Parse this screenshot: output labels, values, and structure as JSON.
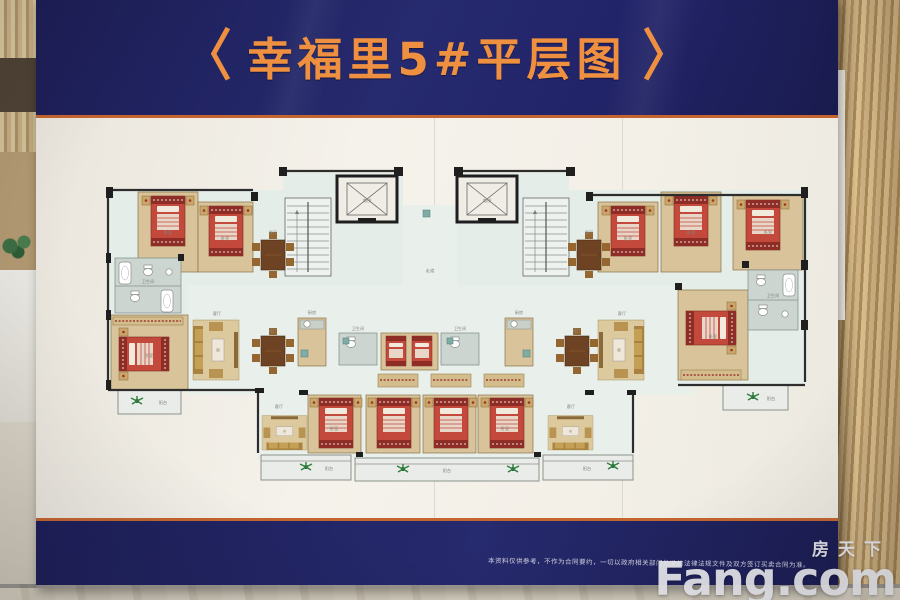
{
  "header": {
    "bracket_left": "〈",
    "title": "幸福里5#平层图",
    "bracket_right": "〉"
  },
  "footer": {
    "disclaimer": "本资料仅供参考，不作为合同要约，一切以政府相关部门批准的法律法规文件及双方签订买卖合同为准。"
  },
  "watermark": {
    "site_cn": "房天下",
    "site_en": "Fang.com"
  },
  "plan": {
    "name": "幸福里5#平层图",
    "labels": {
      "bedroom": "卧室",
      "living": "客厅",
      "dining": "餐厅",
      "kitchen": "厨房",
      "bath": "卫生间",
      "balcony": "阳台",
      "elevator": "电梯",
      "corridor": "走道"
    },
    "colors": {
      "navy": "#22246a",
      "title_orange": "#ee9040",
      "rule_orange": "#c4652f",
      "paper": "#f3f0e8",
      "floor_tint": "#e5ede9",
      "room_tan": "#d8c39a",
      "bed_red": "#c2493b",
      "bath_gray": "#ccd5d0",
      "balcony_gray": "#e9ece8",
      "plant_green": "#2f7d3e",
      "wall_dark": "#1f1f1f"
    }
  }
}
